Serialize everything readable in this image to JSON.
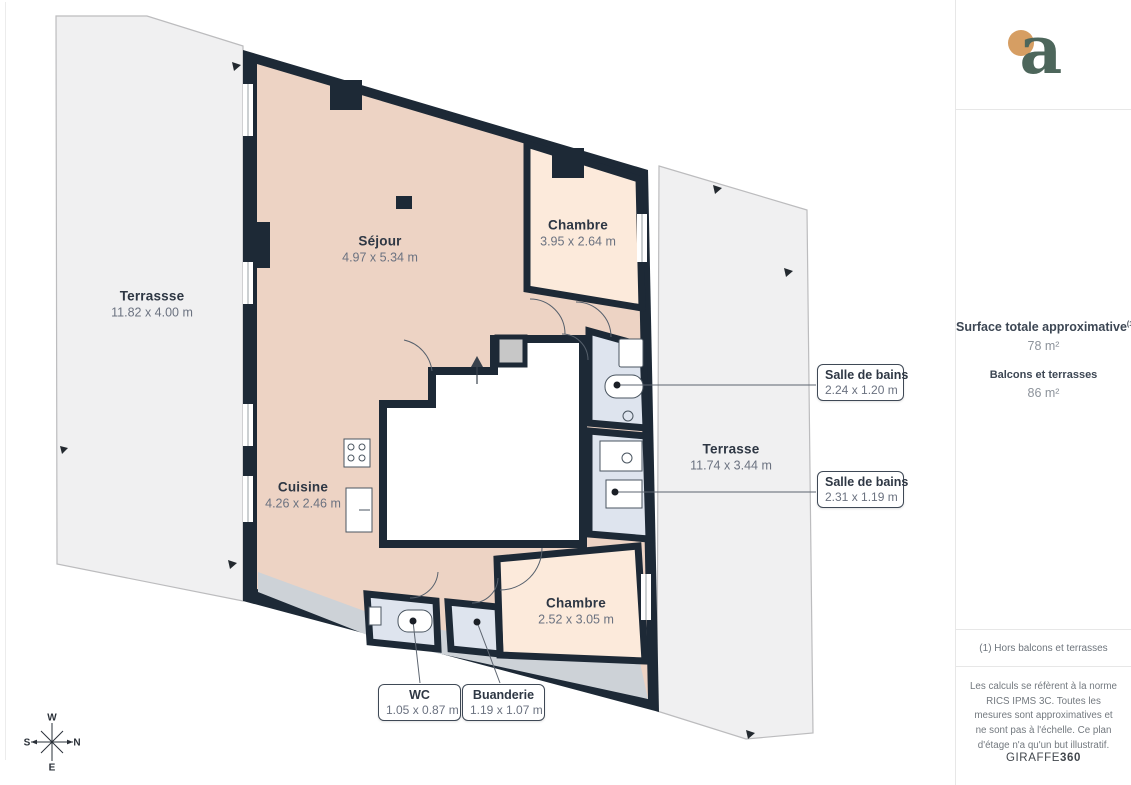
{
  "plan": {
    "rooms": [
      {
        "id": "terrasse-ouest",
        "name": "Terrassse",
        "dims": "11.82 x 4.00 m"
      },
      {
        "id": "sejour",
        "name": "Séjour",
        "dims": "4.97 x 5.34 m"
      },
      {
        "id": "chambre-1",
        "name": "Chambre",
        "dims": "3.95 x 2.64 m"
      },
      {
        "id": "terrasse-est",
        "name": "Terrasse",
        "dims": "11.74 x 3.44 m"
      },
      {
        "id": "cuisine",
        "name": "Cuisine",
        "dims": "4.26 x 2.46 m"
      },
      {
        "id": "chambre-2",
        "name": "Chambre",
        "dims": "2.52 x 3.05 m"
      }
    ],
    "callouts": [
      {
        "id": "salle-de-bains-1",
        "name": "Salle de bains",
        "dims": "2.24 x 1.20 m"
      },
      {
        "id": "salle-de-bains-2",
        "name": "Salle de bains",
        "dims": "2.31 x 1.19 m"
      },
      {
        "id": "wc",
        "name": "WC",
        "dims": "1.05 x 0.87 m"
      },
      {
        "id": "buanderie",
        "name": "Buanderie",
        "dims": "1.19 x 1.07 m"
      }
    ],
    "compass": {
      "west": "W",
      "north": "N",
      "south": "S",
      "east": "E"
    }
  },
  "sidebar": {
    "logo_letter": "a",
    "surface_title": "Surface totale approximative",
    "surface_sup": "(1)",
    "surface_value": "78 m²",
    "balconies_title": "Balcons et terrasses",
    "balconies_value": "86 m²",
    "footnote": "(1) Hors balcons et terrasses",
    "disclaimer": "Les calculs se réfèrent à la norme RICS IPMS 3C. Toutes les mesures sont approximatives et ne sont pas à l'échelle. Ce plan d'étage n'a qu'un but illustratif.",
    "brand_name": "GIRAFFE",
    "brand_number": "360"
  },
  "colors": {
    "wall": "#1d2936",
    "living": "#edd3c4",
    "bedroom": "#fceadb",
    "bathroom": "#dee4ee",
    "terrace": "#f0f0f1",
    "balcony_gray": "#cdd2d7",
    "logo_green": "#4d665b",
    "logo_dot": "#d69e63"
  }
}
